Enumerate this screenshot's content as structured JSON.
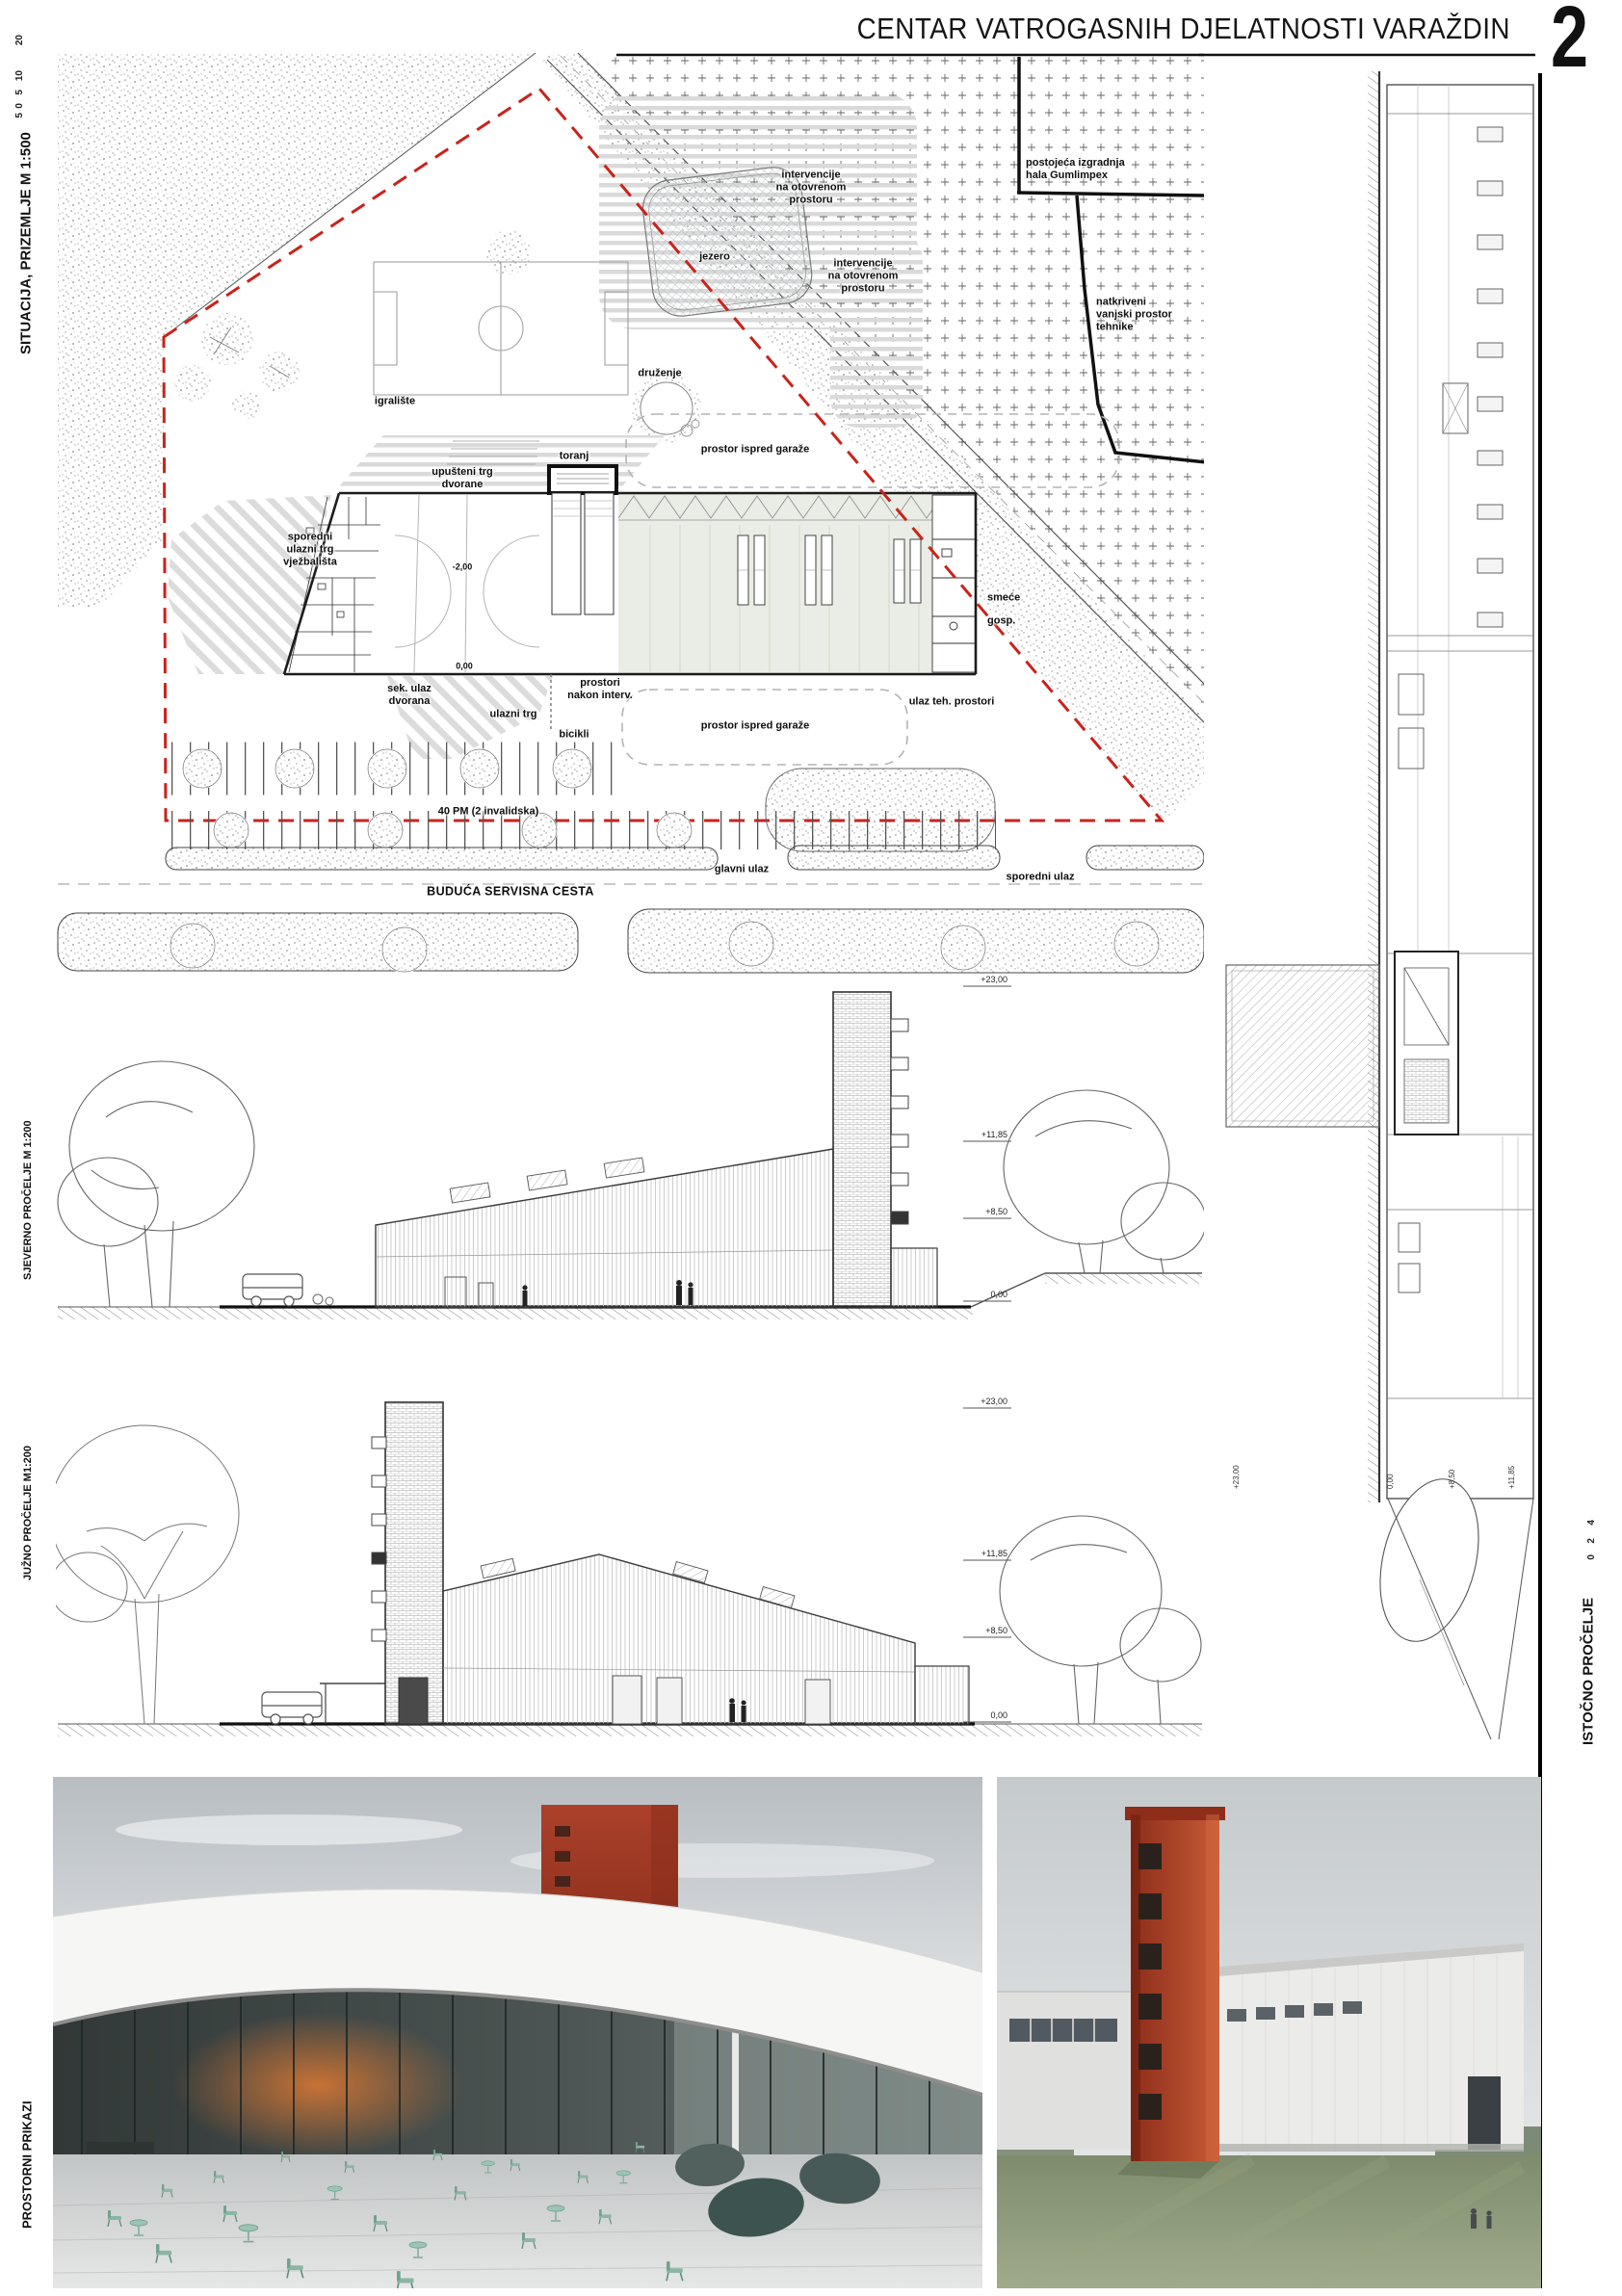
{
  "header": {
    "title": "CENTAR VATROGASNIH DJELATNOSTI VARAŽDIN",
    "page_number": "2"
  },
  "margins": {
    "situacija": "SITUACIJA, PRIZEMLJE M 1:500",
    "situacija_ticks": [
      "20",
      "10",
      "5",
      "0",
      "5"
    ],
    "sjeverno": "SJEVERNO PROČELJE M 1:200",
    "juzno": "JUŽNO PROČELJE M1:200",
    "istocno": "ISTOČNO PROČELJE",
    "istocno_ticks": [
      "4",
      "2",
      "0"
    ],
    "prostorni": "PROSTORNI PRIKAZI"
  },
  "site_plan": {
    "labels": {
      "intervencije_gore": "intervencije\nna otovrenom\nprostoru",
      "jezero": "jezero",
      "intervencije_dolje": "intervencije\nna otovrenom\nprostoru",
      "postojeca": "postojeća izgradnja\nhala Gumlimpex",
      "natkriveni": "natkriveni\nvanjski prostor\ntehnike",
      "igraliste": "igralište",
      "druzenje": "druženje",
      "toranj": "toranj",
      "prostor_garaze_gore": "prostor ispred garaže",
      "upusteni_trg": "upušteni trg\ndvorane",
      "sporedni_trg": "sporedni\nulazni trg\nvježbališta",
      "smece": "smeće",
      "gosp": "gosp.",
      "sek_ulaz": "sek. ulaz\ndvorana",
      "ulazni_trg": "ulazni trg",
      "prostori_nakon": "prostori\nnakon interv.",
      "bicikli": "bicikli",
      "prostor_garaze_dolje": "prostor ispred garaže",
      "ulaz_teh": "ulaz teh. prostori",
      "parking": "40 PM (2 invalidska)",
      "cesta": "BUDUĆA SERVISNA CESTA",
      "glavni_ulaz": "glavni ulaz",
      "sporedni_ulaz": "sporedni ulaz",
      "level_minus": "-2,00",
      "level_nula": "0,00"
    }
  },
  "elevations": {
    "north": [
      "+23,00",
      "+11,85",
      "+8,50",
      "0,00"
    ],
    "south": [
      "+23,00",
      "+11,85",
      "+8,50",
      "0,00"
    ],
    "east": [
      "+23,00",
      "0,00",
      "+8,50",
      "+11,85"
    ]
  },
  "colors": {
    "boundary_red": "#c9231c",
    "tower_red": "#a83b24",
    "furniture_green": "#8cbfae",
    "garage_fill": "#e9ede5"
  }
}
